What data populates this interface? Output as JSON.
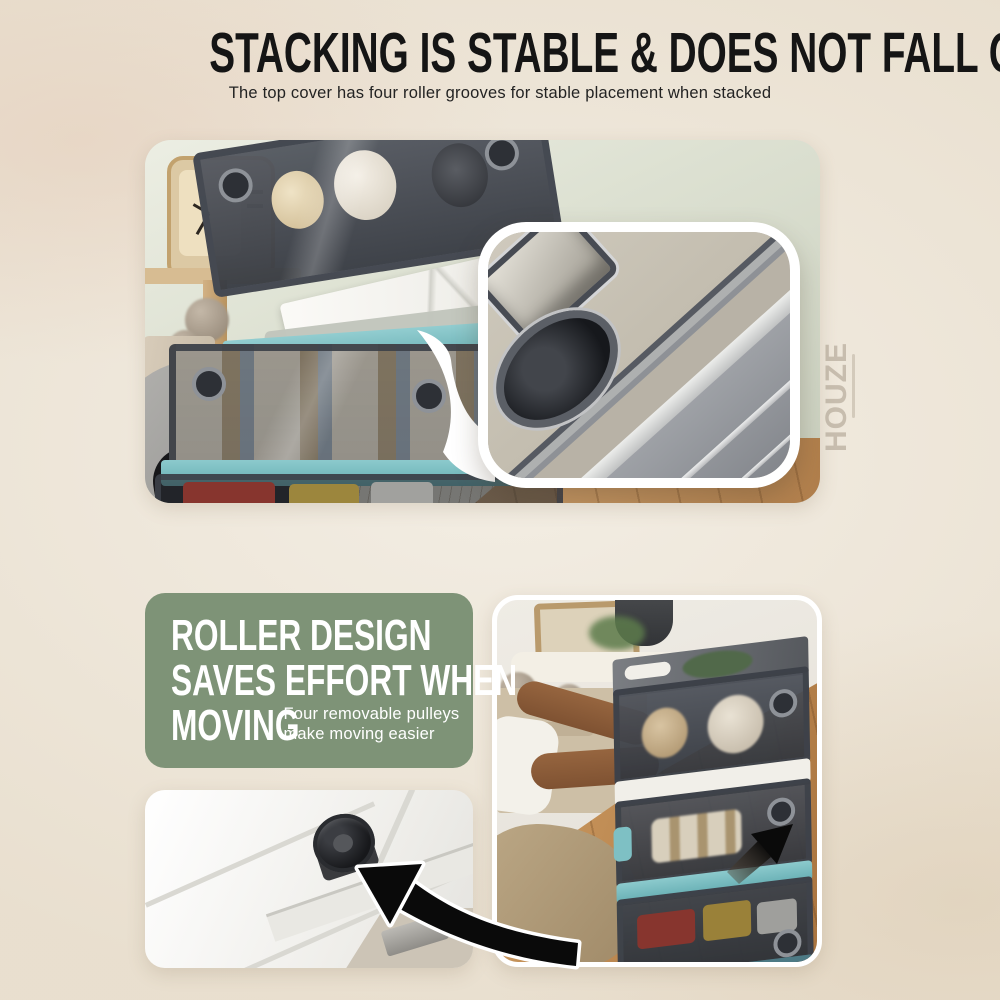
{
  "header": {
    "title": "STACKING IS STABLE & DOES NOT FALL OVER",
    "subtitle": "The top cover has four roller grooves for stable placement when stacked"
  },
  "feature_card": {
    "heading_line1": "ROLLER DESIGN",
    "heading_line2": "SAVES EFFORT WHEN",
    "heading_line3": "MOVING",
    "note": "Four removable pulleys make moving easier"
  },
  "watermark": {
    "brand": "HOUZE"
  },
  "colors": {
    "bg": "#efe8db",
    "title_text": "#151515",
    "card_green": "#7e9377",
    "card_text": "#ffffff",
    "teal_accent": "#7ec4c8",
    "arrow_black": "#0a0a0a",
    "inset_border": "#ffffff"
  }
}
